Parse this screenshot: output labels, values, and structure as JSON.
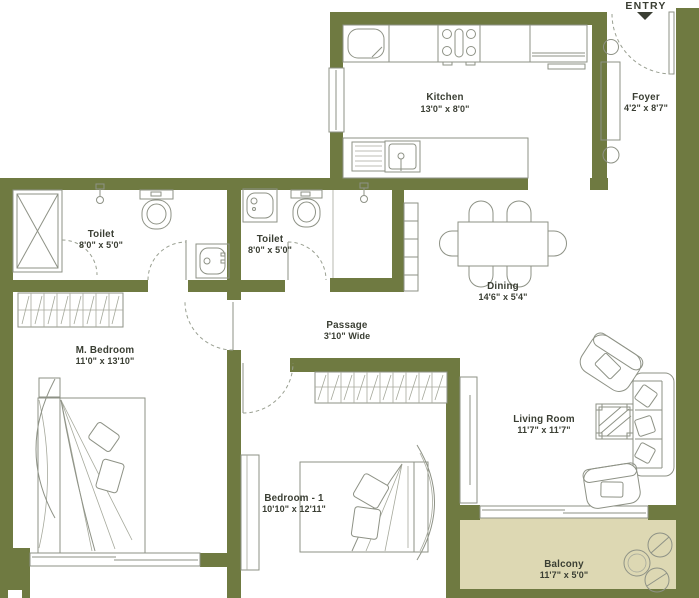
{
  "floor_plan": {
    "entry_label": "ENTRY",
    "rooms": [
      {
        "name": "Kitchen",
        "dims": "13'0\" x 8'0\""
      },
      {
        "name": "Foyer",
        "dims": "4'2\" x 8'7\""
      },
      {
        "name": "Toilet",
        "dims": "8'0\" x 5'0\""
      },
      {
        "name": "Toilet",
        "dims": "8'0\" x 5'0\""
      },
      {
        "name": "Dining",
        "dims": "14'6\" x 5'4\""
      },
      {
        "name": "Passage",
        "dims": "3'10\" Wide"
      },
      {
        "name": "M. Bedroom",
        "dims": "11'0\" x 13'10\""
      },
      {
        "name": "Bedroom - 1",
        "dims": "10'10\" x 12'11\""
      },
      {
        "name": "Living Room",
        "dims": "11'7\" x 11'7\""
      },
      {
        "name": "Balcony",
        "dims": "11'7\" x 5'0\""
      }
    ],
    "colors": {
      "wall": "#6f7a41",
      "balcony_floor": "#ddd8b3",
      "furniture_line": "#8e9286",
      "label_text": "#3a3e33",
      "background": "#ffffff"
    }
  }
}
